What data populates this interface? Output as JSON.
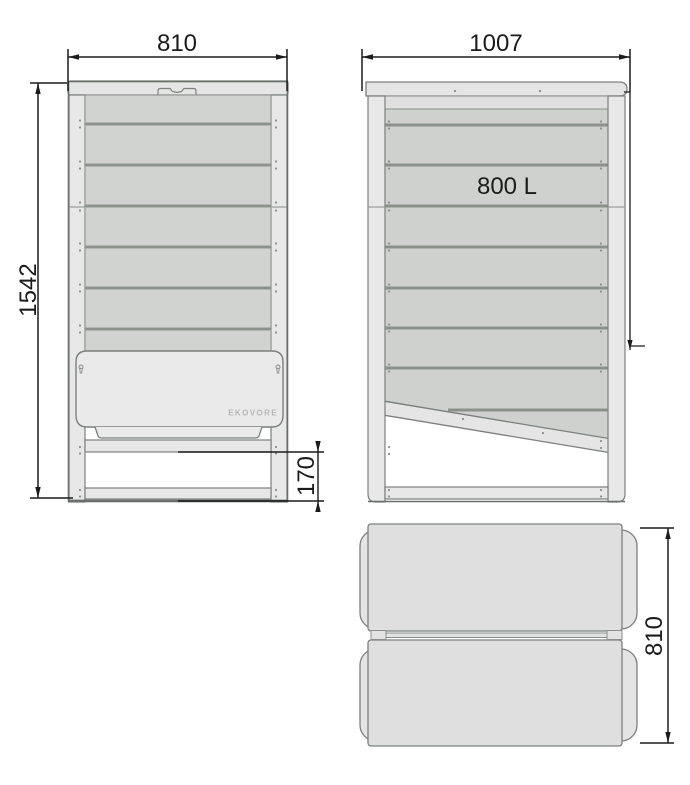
{
  "drawing": {
    "type": "technical-drawing",
    "views": [
      "front",
      "side",
      "top"
    ]
  },
  "front_view": {
    "width_label": "810",
    "height_label": "1542",
    "opening_label": "170",
    "brand_label": "EKOVORE"
  },
  "side_view": {
    "width_label": "1007",
    "capacity_label": "800 L"
  },
  "top_view": {
    "depth_label": "810"
  },
  "colors": {
    "background": "#ffffff",
    "frame_light": "#e7e8e7",
    "cap_fill": "#e4e5e4",
    "slat_fill": "#d1d3d1",
    "slat_fill_side": "#cfd1cf",
    "slat_divider": "#7c827d",
    "flap_fill": "#e9eae9",
    "outline": "#6b6f6c",
    "dimension_line": "#1b1b1b",
    "brand_text": "#b6b6b6",
    "screw_dot": "#8b908c"
  }
}
